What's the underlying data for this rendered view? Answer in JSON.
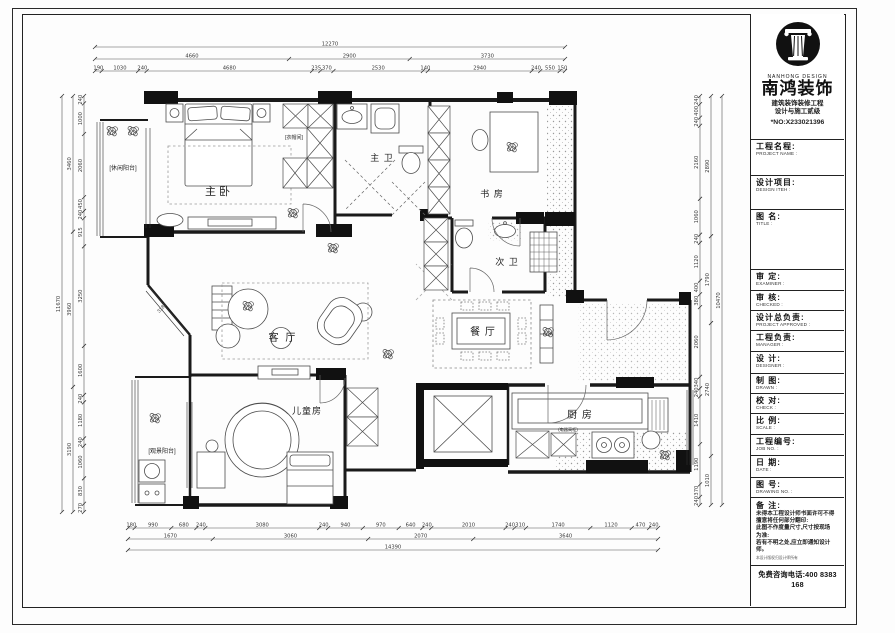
{
  "title_block": {
    "brand_en": "NANHONG DESIGN",
    "brand_cn": "南鸿装饰",
    "cert_line1": "建筑装饰装修工程",
    "cert_line2": "设计与施工贰级",
    "license_no": "*NO:X233021396",
    "fields": [
      {
        "cn": "工程名程:",
        "en": "PROJECT NAME :"
      },
      {
        "cn": "设计项目:",
        "en": "DESIGN ITEH :"
      },
      {
        "cn": "图 名:",
        "en": "TITLE :"
      },
      {
        "cn": "审 定:",
        "en": "EXAMINER :"
      },
      {
        "cn": "审 核:",
        "en": "CHECKED :"
      },
      {
        "cn": "设计总负责:",
        "en": "PROJECT APPROVED :"
      },
      {
        "cn": "工程负责:",
        "en": "MANAGER :"
      },
      {
        "cn": "设 计:",
        "en": "DESIGNER :"
      },
      {
        "cn": "制 图:",
        "en": "DRAWN :"
      },
      {
        "cn": "校 对:",
        "en": "CHECK :"
      },
      {
        "cn": "比 例:",
        "en": "SCALE :"
      },
      {
        "cn": "工程编号:",
        "en": "JOB NO. :"
      },
      {
        "cn": "日 期:",
        "en": "DATE :"
      },
      {
        "cn": "图 号:",
        "en": "DRAWING NO. :"
      }
    ],
    "notes_label": "备 注:",
    "notes": [
      "未得本工程设计师书面许可不得",
      "擅意将任何部分翻印:",
      "此图不作度量尺寸,尺寸按现场",
      "为准:",
      "若有不明之处,应立即通知设计",
      "师。"
    ],
    "fine_print": "本设计版权归设计师所有",
    "phone": "免费咨询电话:400 8383 168"
  },
  "rooms": {
    "master_bedroom": "主卧",
    "master_bath": "主 卫",
    "study": "书 房",
    "second_bath": "次 卫",
    "living": "客 厅",
    "dining": "餐 厅",
    "kids": "儿童房",
    "kitchen": "厨 房",
    "leisure_balcony": "[休闲阳台]",
    "view_balcony": "[观景阳台]",
    "cloakroom": "[衣帽间]",
    "appliance_cabinet": "(电器高柜)"
  },
  "dimensions": {
    "top": {
      "overall": [
        "12270"
      ],
      "mid": [
        "4660",
        "2900",
        "3730"
      ],
      "detail": [
        "190",
        "1030",
        "240",
        "4680",
        "235",
        "370",
        "2530",
        "140",
        "2940",
        "240",
        "550",
        "150"
      ]
    },
    "bottom": {
      "detail": [
        "180",
        "990",
        "680",
        "240",
        "3080",
        "240",
        "940",
        "970",
        "640",
        "240",
        "2010",
        "240",
        "310",
        "1740",
        "1120",
        "470",
        "240"
      ],
      "mid": [
        "1670",
        "3060",
        "2070",
        "3640"
      ],
      "overall": [
        "14390"
      ]
    },
    "left": {
      "detail": [
        "240",
        "1000",
        "2060",
        "450",
        "240",
        "915",
        "3250",
        "1600",
        "240",
        "1180",
        "240",
        "1060",
        "830",
        "270"
      ],
      "mid": [
        "3460",
        "3960",
        "3190"
      ],
      "overall": [
        "11670"
      ]
    },
    "right": {
      "detail": [
        "240",
        "400",
        "240",
        "2160",
        "1060",
        "240",
        "1120",
        "400",
        "380",
        "2060",
        "340",
        "240",
        "1410",
        "1190",
        "370",
        "240"
      ],
      "mid": [
        "2890",
        "1790",
        "2740",
        "1010"
      ],
      "overall": [
        "10470"
      ]
    },
    "diagonal": "3180"
  }
}
